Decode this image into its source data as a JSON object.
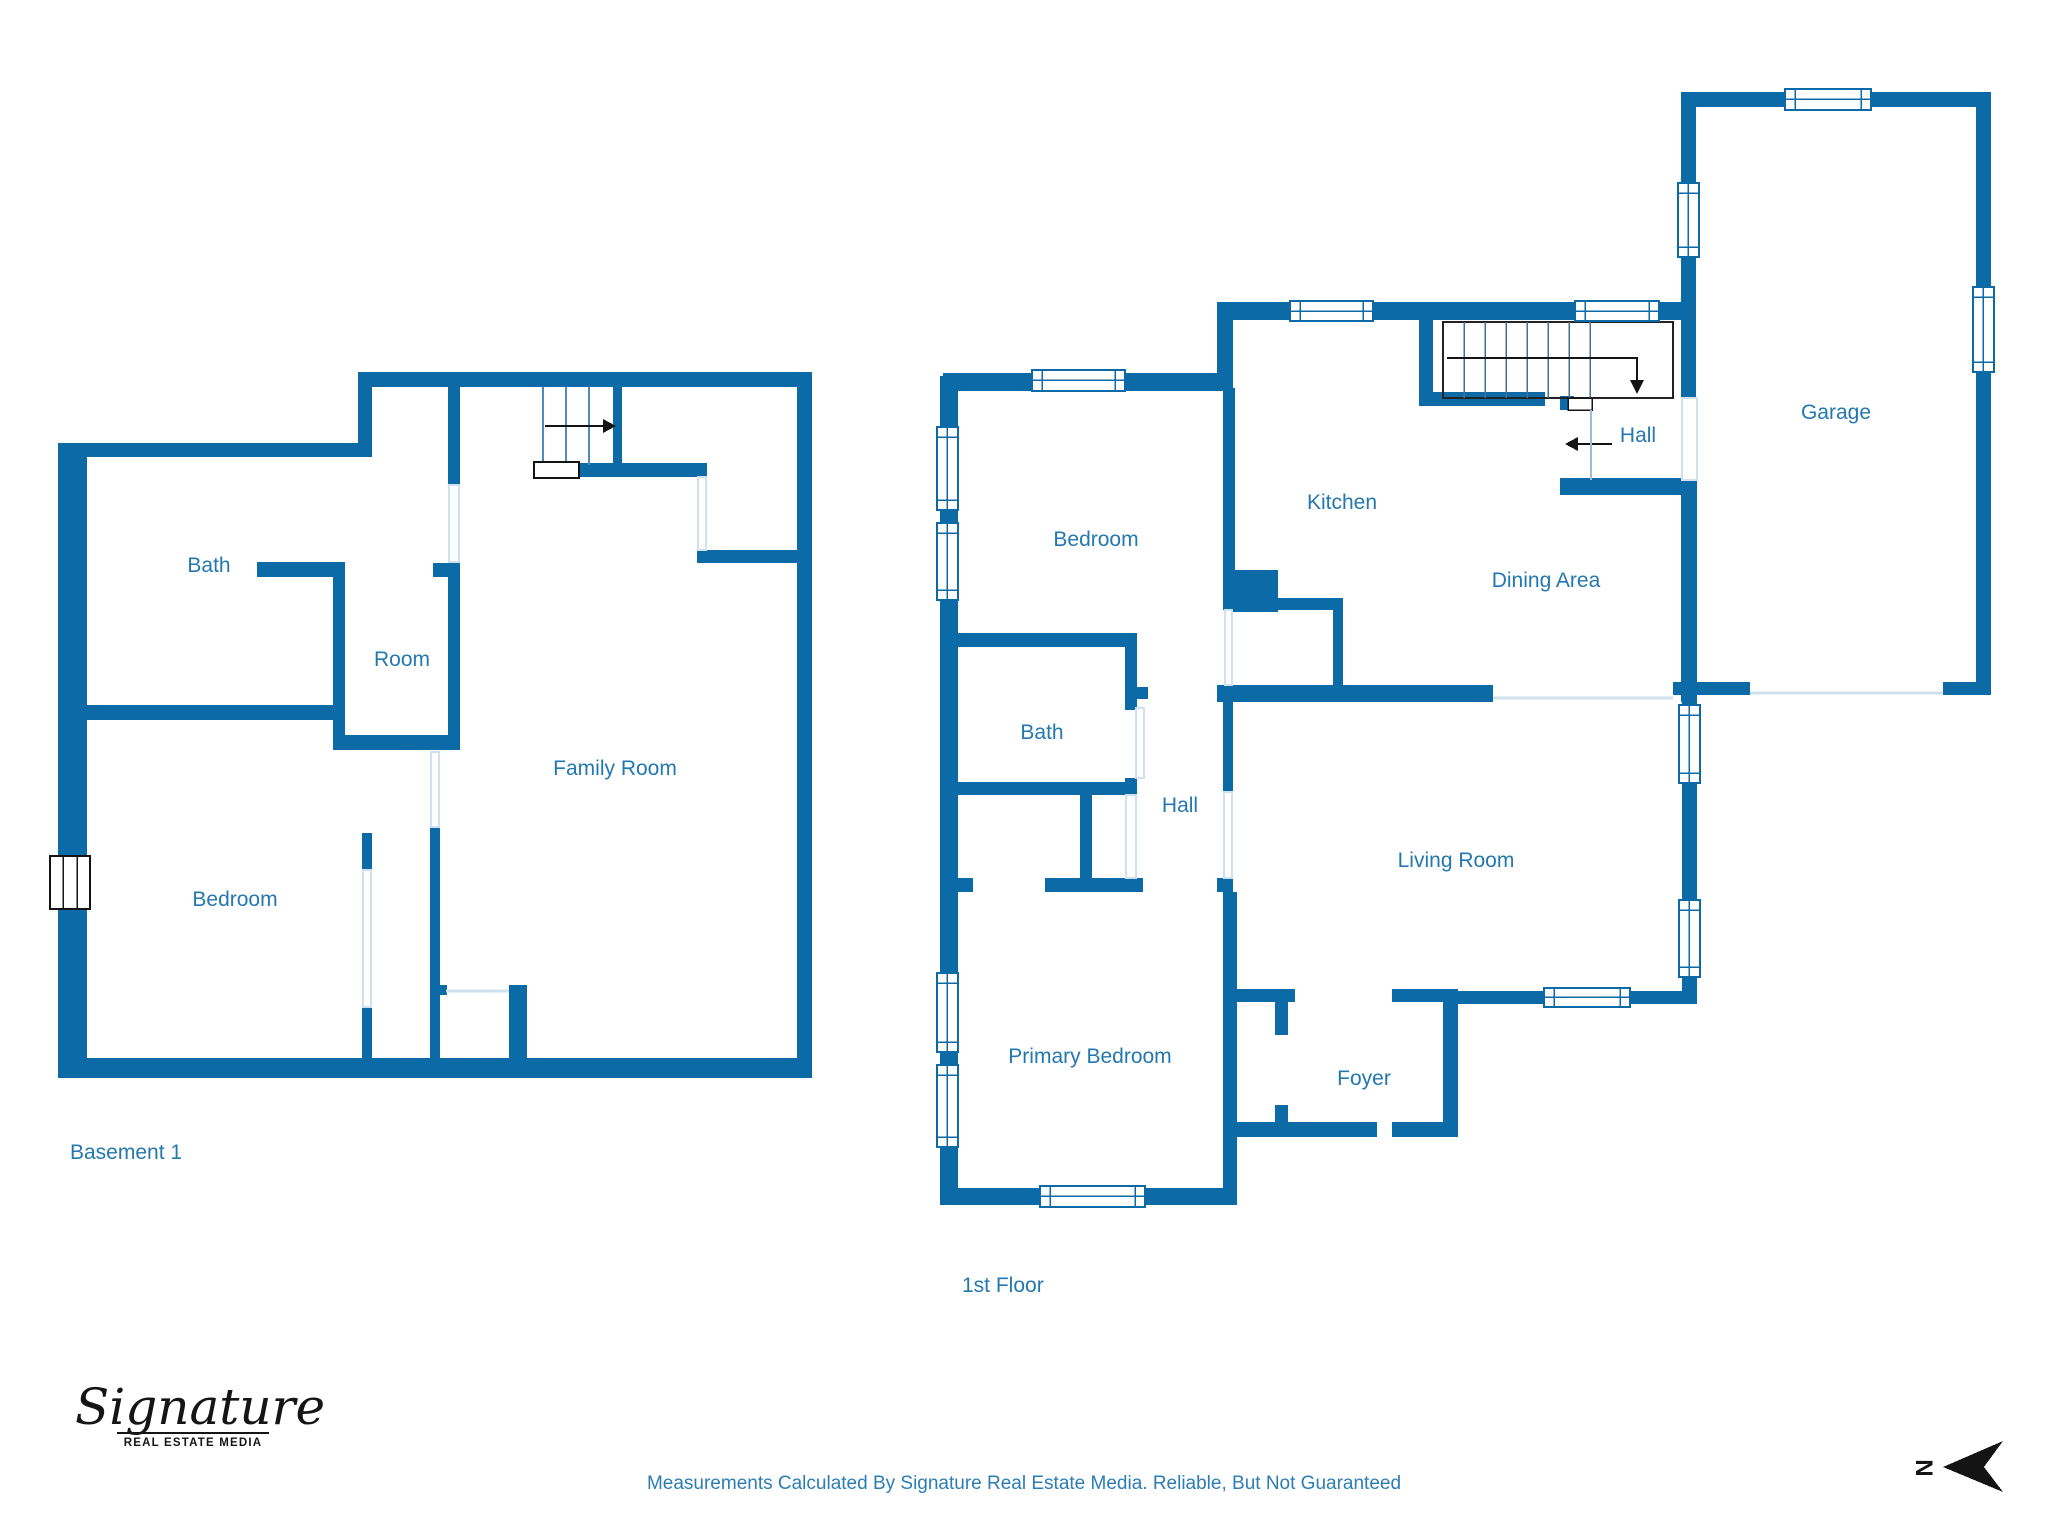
{
  "palette": {
    "wall_blue": "#0c6aa6",
    "label_blue": "#2478b0",
    "disclaimer_blue": "#2b7db4",
    "opening_line": "#cfe0ee",
    "ink_black": "#141414"
  },
  "basement": {
    "title": "Basement 1",
    "rooms": [
      {
        "label": "Bath"
      },
      {
        "label": "Room"
      },
      {
        "label": "Family Room"
      },
      {
        "label": "Bedroom"
      }
    ]
  },
  "first_floor": {
    "title": "1st Floor",
    "rooms": [
      {
        "label": "Bedroom"
      },
      {
        "label": "Kitchen"
      },
      {
        "label": "Hall"
      },
      {
        "label": "Garage"
      },
      {
        "label": "Dining Area"
      },
      {
        "label": "Bath"
      },
      {
        "label": "Hall"
      },
      {
        "label": "Living Room"
      },
      {
        "label": "Primary Bedroom"
      },
      {
        "label": "Foyer"
      }
    ]
  },
  "footer": {
    "disclaimer": "Measurements Calculated By Signature Real Estate Media. Reliable, But Not Guaranteed"
  },
  "logo": {
    "name": "Signature",
    "tagline": "REAL ESTATE MEDIA"
  },
  "compass": {
    "label": "N"
  }
}
